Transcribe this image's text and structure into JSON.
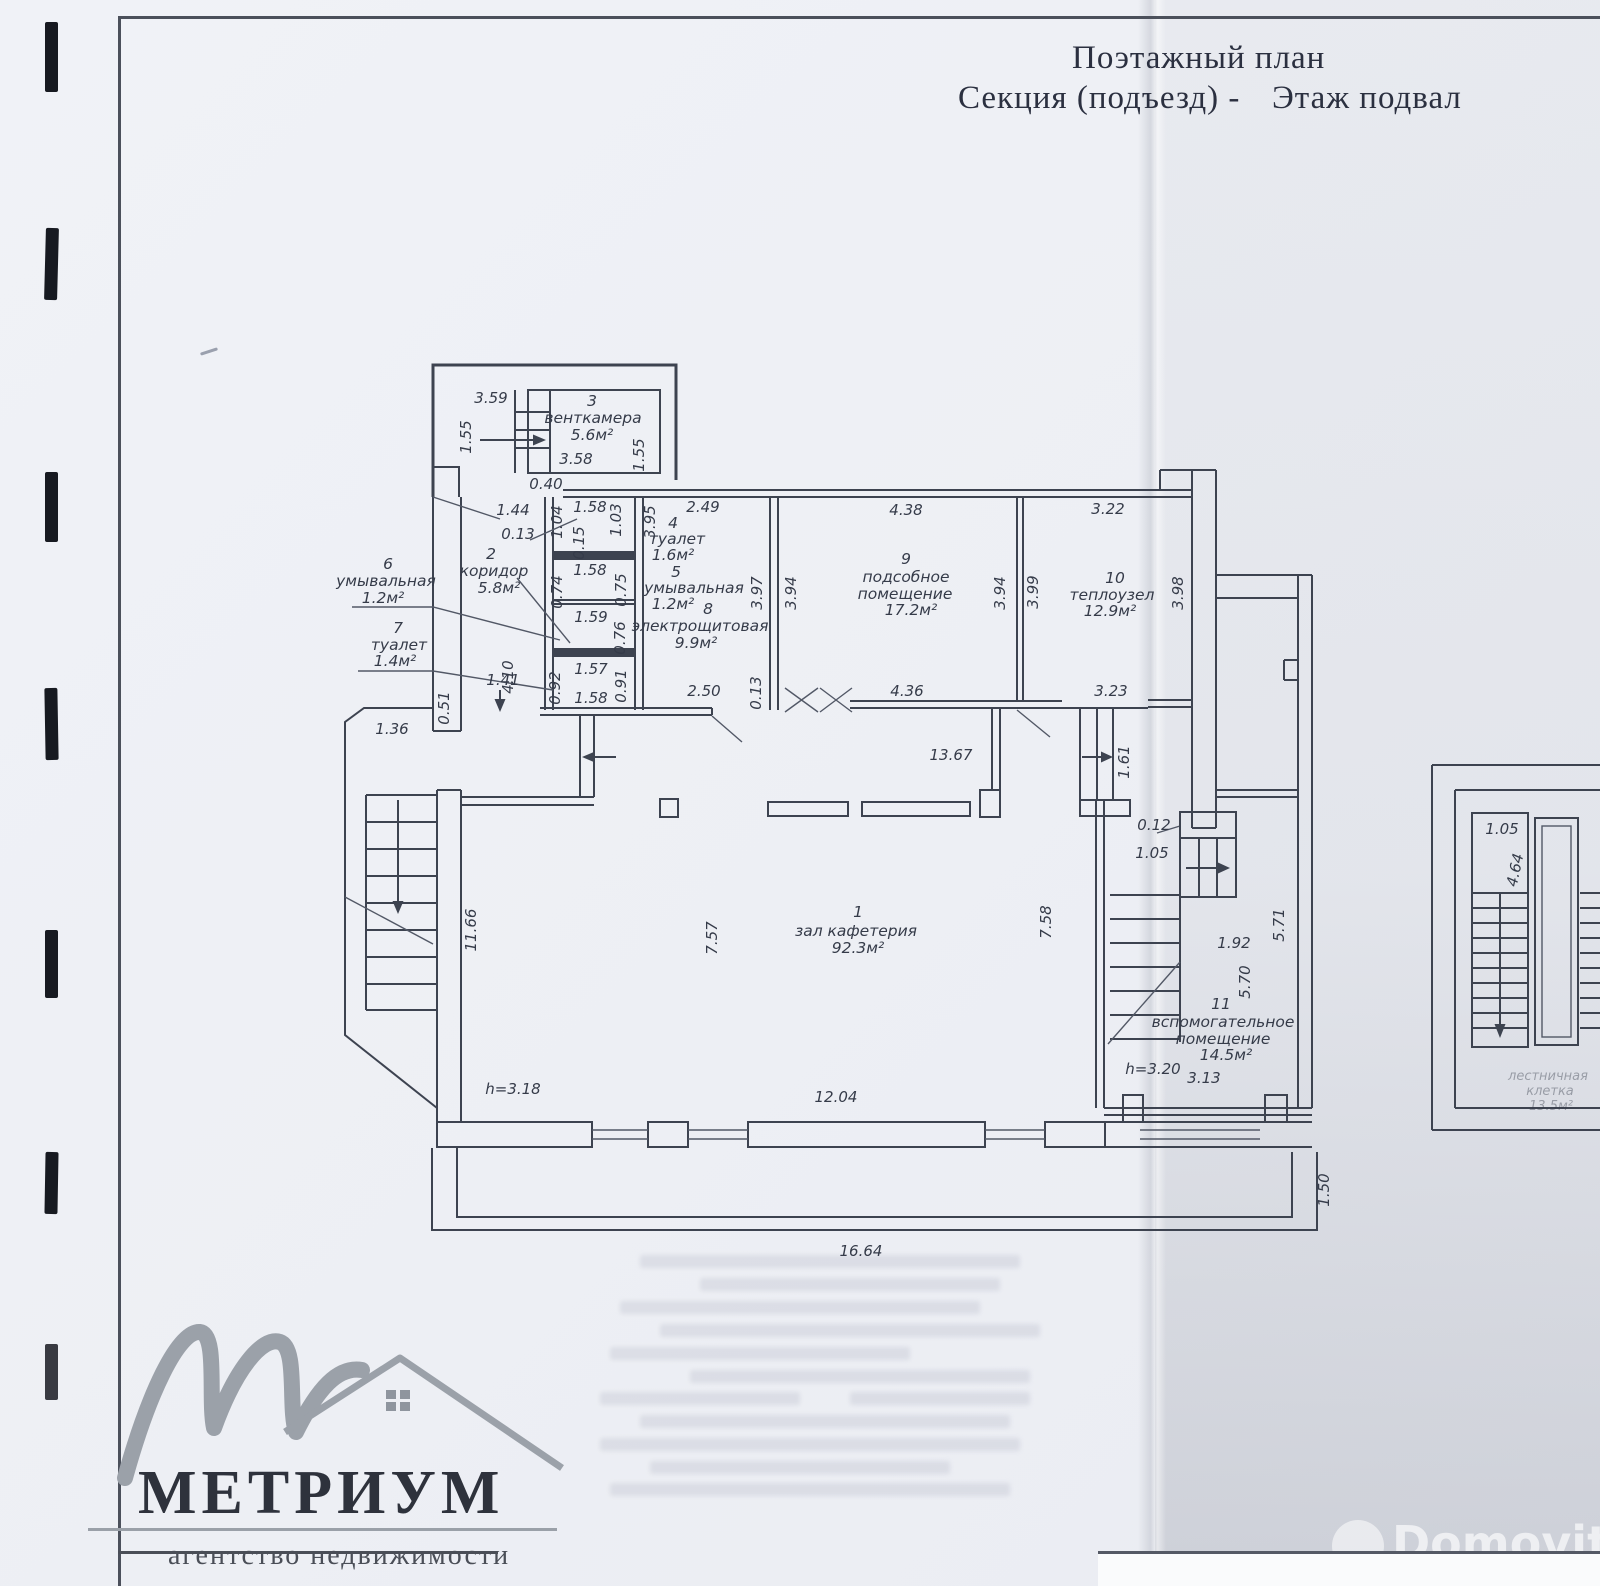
{
  "document": {
    "title": "Поэтажный план",
    "subtitle_left": "Секция (подъезд) -",
    "subtitle_right": "Этаж подвал"
  },
  "rooms": {
    "hall": {
      "num": "1",
      "name": "зал кафетерия",
      "area": "92.3м²"
    },
    "corridor": {
      "num": "2",
      "name": "коридор",
      "area": "5.8м²"
    },
    "ventkamera": {
      "num": "3",
      "name": "венткамера",
      "area": "5.6м²"
    },
    "toilet4": {
      "num": "4",
      "name": "туалет",
      "area": "1.6м²"
    },
    "washroom5": {
      "num": "5",
      "name": "умывальная",
      "area": "1.2м²"
    },
    "washroom6": {
      "num": "6",
      "name": "умывальная",
      "area": "1.2м²"
    },
    "toilet7": {
      "num": "7",
      "name": "туалет",
      "area": "1.4м²"
    },
    "electrical": {
      "num": "8",
      "name": "электрощитовая",
      "area": "9.9м²"
    },
    "utility9": {
      "num": "9",
      "name1": "подсобное",
      "name2": "помещение",
      "area": "17.2м²"
    },
    "heat": {
      "num": "10",
      "name": "теплоузел",
      "area": "12.9м²"
    },
    "aux11": {
      "num": "11",
      "name1": "вспомогательное",
      "name2": "помещение",
      "area": "14.5м²"
    },
    "stairwell": {
      "name1": "лестничная",
      "name2": "клетка",
      "area": "13.5м²"
    }
  },
  "heights": {
    "hall": "h=3.18",
    "aux": "h=3.20"
  },
  "dims": [
    "3.59",
    "1.55",
    "3.58",
    "1.55",
    "0.40",
    "1.44",
    "0.13",
    "1.04",
    "1.58",
    "0.15",
    "1.03",
    "3.95",
    "2.49",
    "1.58",
    "0.74",
    "0.75",
    "4.10",
    "1.59",
    "0.76",
    "1.57",
    "0.92",
    "0.91",
    "1.58",
    "1.41",
    "0.51",
    "1.36",
    "3.97",
    "3.94",
    "4.38",
    "3.94",
    "3.99",
    "3.22",
    "3.98",
    "4.36",
    "3.23",
    "2.50",
    "0.13",
    "13.67",
    "1.61",
    "0.12",
    "1.05",
    "11.66",
    "7.57",
    "7.58",
    "1.92",
    "5.70",
    "5.71",
    "3.13",
    "12.04",
    "16.64",
    "1.50",
    "1.05",
    "4.64"
  ],
  "branding": {
    "agency_name": "МЕТРИУМ",
    "agency_tagline": "агентство недвижимости",
    "watermark": "Domovita"
  },
  "colors": {
    "ink": "#3d4350",
    "paper": "#edeff4",
    "logo_gray": "#9ba1a9"
  }
}
